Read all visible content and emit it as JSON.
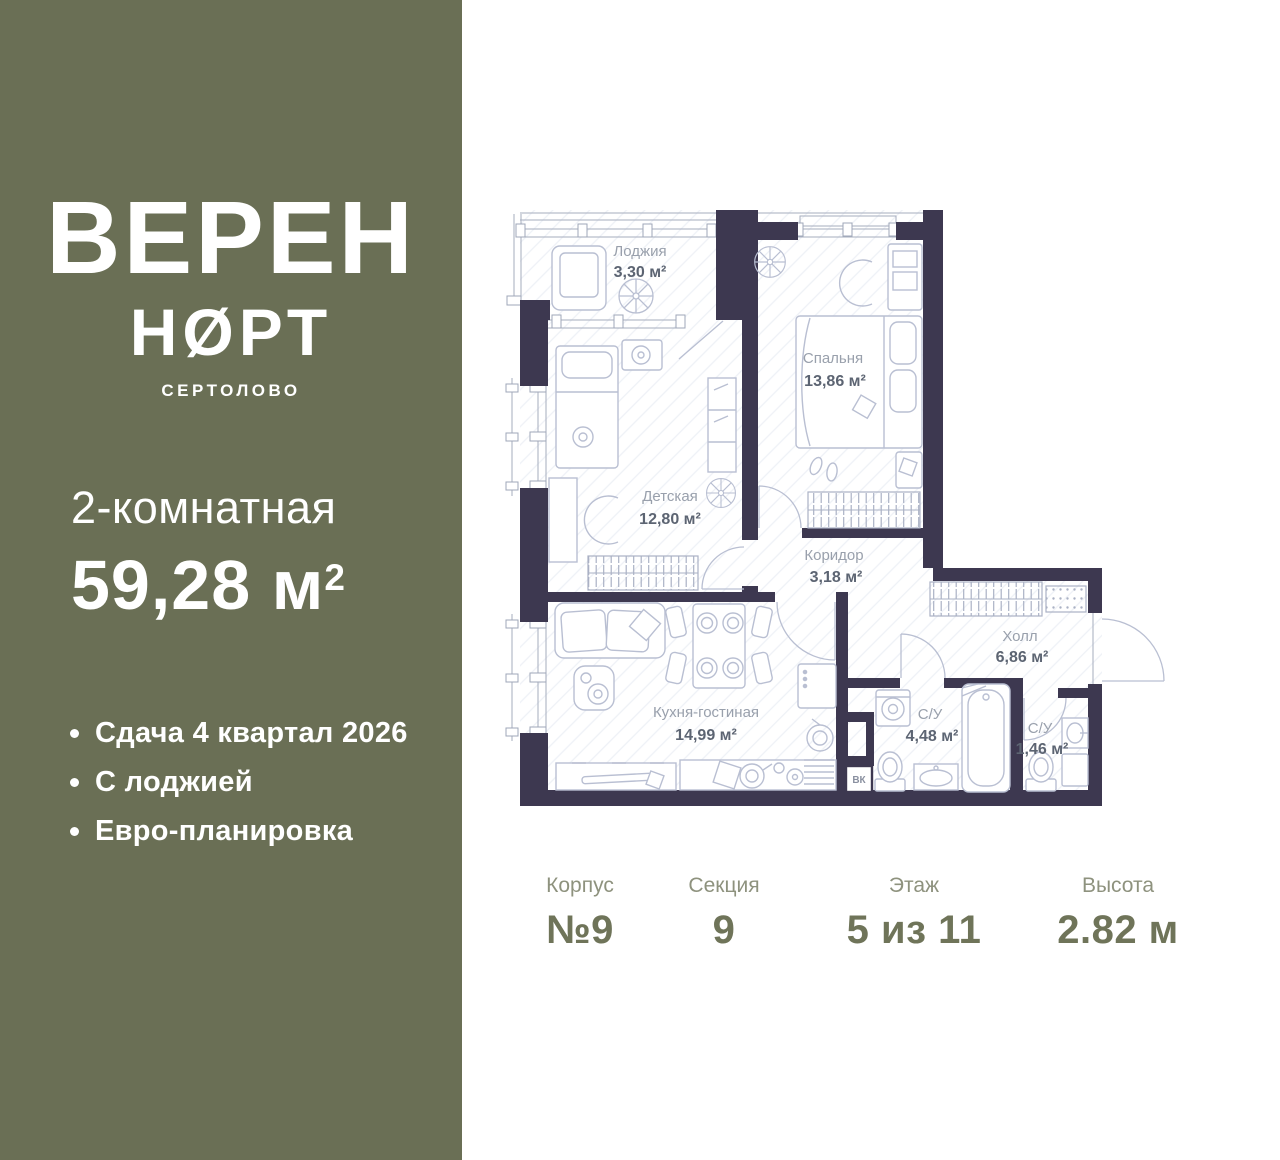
{
  "sidebar": {
    "background": "#6a6f55",
    "brand_line1": "ВЕРЕН",
    "brand_line2": "НØРТ",
    "brand_city": "СЕРТОЛОВО",
    "apartment_type": "2-комнатная",
    "area_value": "59,28 м",
    "area_sup": "2",
    "features": [
      "Сдача 4 квартал 2026",
      "С лоджией",
      "Евро-планировка"
    ]
  },
  "plan": {
    "wall_color": "#3d3850",
    "furniture_color": "#b9bfd2",
    "rooms": [
      {
        "name": "Лоджия",
        "area": "3,30 м²"
      },
      {
        "name": "Спальня",
        "area": "13,86 м²"
      },
      {
        "name": "Детская",
        "area": "12,80 м²"
      },
      {
        "name": "Коридор",
        "area": "3,18 м²"
      },
      {
        "name": "Холл",
        "area": "6,86 м²"
      },
      {
        "name": "Кухня-гостиная",
        "area": "14,99 м²"
      },
      {
        "name": "С/У",
        "area": "4,48 м²"
      },
      {
        "name": "С/У",
        "area": "1,46 м²"
      }
    ],
    "shaft_label": "ВК"
  },
  "details": [
    {
      "label": "Корпус",
      "value": "№9"
    },
    {
      "label": "Секция",
      "value": "9"
    },
    {
      "label": "Этаж",
      "value": "5 из 11"
    },
    {
      "label": "Высота",
      "value": "2.82 м"
    }
  ]
}
